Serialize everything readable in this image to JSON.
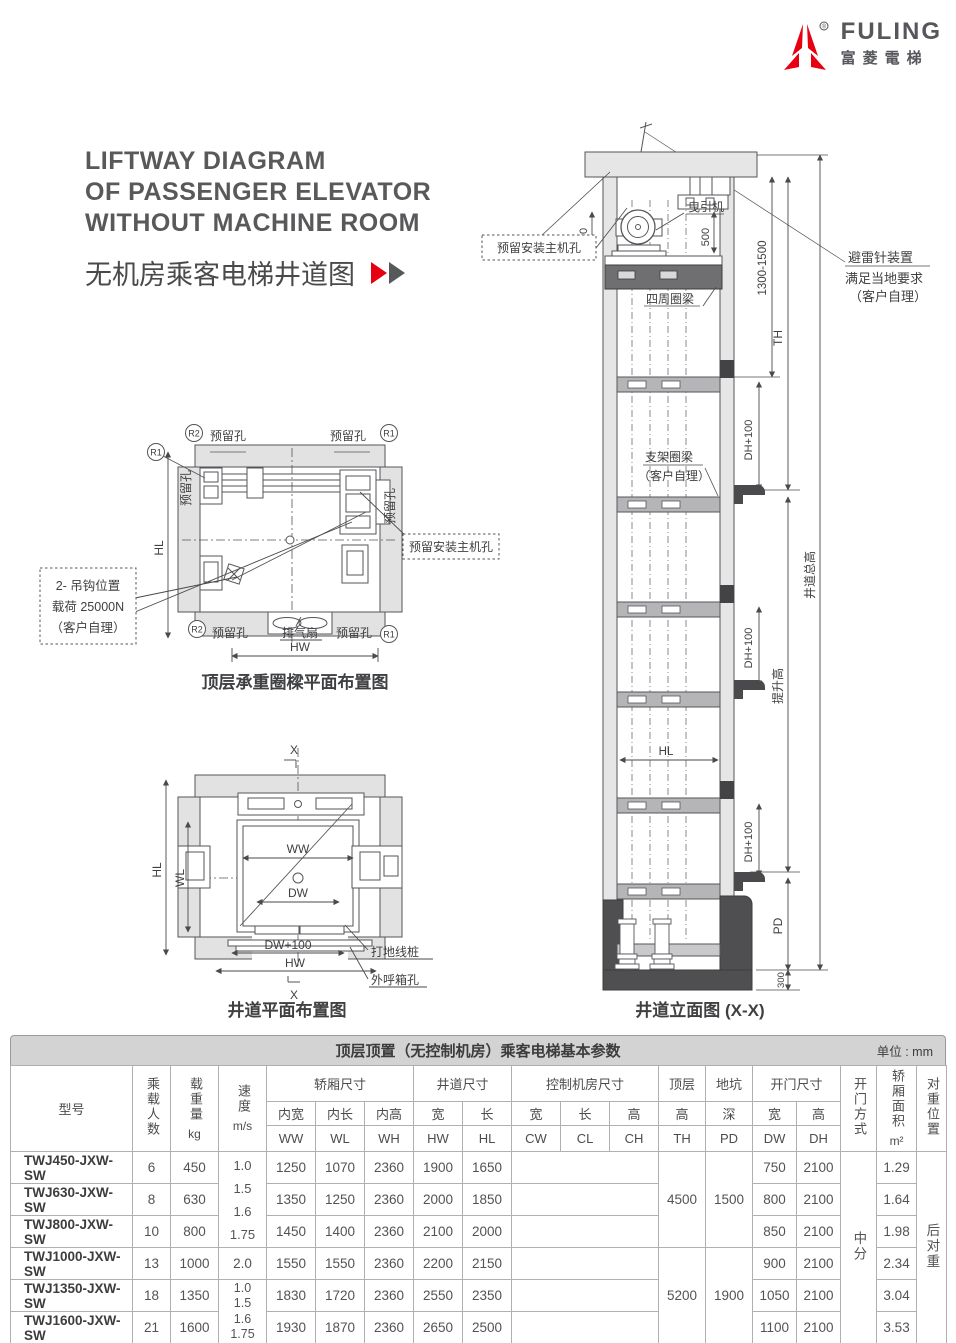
{
  "logo": {
    "brand": "FULING",
    "brand_cn": "富菱電梯",
    "reg": "®"
  },
  "header": {
    "title_l1": "LIFTWAY DIAGRAM",
    "title_l2": "OF PASSENGER ELEVATOR",
    "title_l3": "WITHOUT MACHINE ROOM",
    "subtitle": "无机房乘客电梯井道图"
  },
  "plan_top": {
    "caption": "顶层承重圈樑平面布置图",
    "r1": "R1",
    "r2": "R2",
    "hole_tl": "预留孔",
    "hole_tr": "预留孔",
    "hole_left": "预留孔",
    "hole_right": "预留孔",
    "hole_bl": "预留孔",
    "hole_br": "预留孔",
    "fan": "排气扇",
    "hw": "HW",
    "hl": "HL",
    "hook_1": "2- 吊钩位置",
    "hook_2": "载荷 25000N",
    "hook_3": "（客户自理）",
    "machine_hole": "预留安装主机孔"
  },
  "plan_bottom": {
    "caption": "井道平面布置图",
    "x_top": "X",
    "x_bottom": "X",
    "hl": "HL",
    "wl": "WL",
    "ww": "WW",
    "dw": "DW",
    "dw_100": "DW+100",
    "hw": "HW",
    "ground_stake": "打地线桩",
    "call_box": "外呼箱孔"
  },
  "elevation": {
    "caption": "井道立面图 (X-X)",
    "machine_hole": "预留安装主机孔",
    "traction": "曳引机",
    "d500_l": "500",
    "d500_r": "500",
    "d1300": "1300-1500",
    "lightning_1": "避雷针装置",
    "lightning_2": "满足当地要求",
    "lightning_3": "（客户自理）",
    "ring_beam": "四周圈梁",
    "support_1": "支架圈梁",
    "support_2": "（客户自理）",
    "th": "TH",
    "hl": "HL",
    "dh1": "DH+100",
    "dh2": "DH+100",
    "dh3": "DH+100",
    "total_h": "井道总高",
    "lift_h": "提升高",
    "pd": "PD",
    "d300": "300"
  },
  "table": {
    "title": "顶层顶置（无控制机房）乘客电梯基本参数",
    "unit": "单位 : mm",
    "h": {
      "model": "型号",
      "persons": "乘载人数",
      "load": "载重量",
      "load_unit": "kg",
      "speed": "速度",
      "speed_unit": "m/s",
      "car": "轿厢尺寸",
      "car_w": "内宽",
      "car_w2": "WW",
      "car_l": "内长",
      "car_l2": "WL",
      "car_h": "内高",
      "car_h2": "WH",
      "shaft": "井道尺寸",
      "shaft_w": "宽",
      "shaft_w2": "HW",
      "shaft_l": "长",
      "shaft_l2": "HL",
      "ctrl": "控制机房尺寸",
      "ctrl_w": "宽",
      "ctrl_w2": "CW",
      "ctrl_l": "长",
      "ctrl_l2": "CL",
      "ctrl_h": "高",
      "ctrl_h2": "CH",
      "top": "顶层",
      "top2": "高",
      "top3": "TH",
      "pit": "地坑",
      "pit2": "深",
      "pit3": "PD",
      "door": "开门尺寸",
      "door_w": "宽",
      "door_w2": "DW",
      "door_h": "高",
      "door_h2": "DH",
      "door_type": "开门方式",
      "area": "轿厢面积",
      "area_unit": "m²",
      "cwt": "对重位置"
    },
    "merged": {
      "speed_a": "1.0\n1.5\n1.6\n1.75",
      "speed_b": "1.0\n1.5\n1.6\n1.75",
      "th_a": "4500",
      "th_b": "5200",
      "pd_a": "1500",
      "pd_b": "1900",
      "door_type": "中分",
      "cwt": "后对重"
    },
    "rows": [
      {
        "model": "TWJ450-JXW-SW",
        "persons": "6",
        "load": "450",
        "car_w": "1250",
        "car_l": "1070",
        "car_h": "2360",
        "shaft_w": "1900",
        "shaft_l": "1650",
        "door_w": "750",
        "door_h": "2100",
        "area": "1.29"
      },
      {
        "model": "TWJ630-JXW-SW",
        "persons": "8",
        "load": "630",
        "car_w": "1350",
        "car_l": "1250",
        "car_h": "2360",
        "shaft_w": "2000",
        "shaft_l": "1850",
        "door_w": "800",
        "door_h": "2100",
        "area": "1.64"
      },
      {
        "model": "TWJ800-JXW-SW",
        "persons": "10",
        "load": "800",
        "car_w": "1450",
        "car_l": "1400",
        "car_h": "2360",
        "shaft_w": "2100",
        "shaft_l": "2000",
        "door_w": "850",
        "door_h": "2100",
        "area": "1.98"
      },
      {
        "model": "TWJ1000-JXW-SW",
        "persons": "13",
        "load": "1000",
        "speed": "2.0",
        "car_w": "1550",
        "car_l": "1550",
        "car_h": "2360",
        "shaft_w": "2200",
        "shaft_l": "2150",
        "door_w": "900",
        "door_h": "2100",
        "area": "2.34"
      },
      {
        "model": "TWJ1350-JXW-SW",
        "persons": "18",
        "load": "1350",
        "car_w": "1830",
        "car_l": "1720",
        "car_h": "2360",
        "shaft_w": "2550",
        "shaft_l": "2350",
        "door_w": "1050",
        "door_h": "2100",
        "area": "3.04"
      },
      {
        "model": "TWJ1600-JXW-SW",
        "persons": "21",
        "load": "1600",
        "car_w": "1930",
        "car_l": "1870",
        "car_h": "2360",
        "shaft_w": "2650",
        "shaft_l": "2500",
        "door_w": "1100",
        "door_h": "2100",
        "area": "3.53"
      }
    ]
  },
  "colors": {
    "accent": "#e60012",
    "ink": "#58595b"
  }
}
